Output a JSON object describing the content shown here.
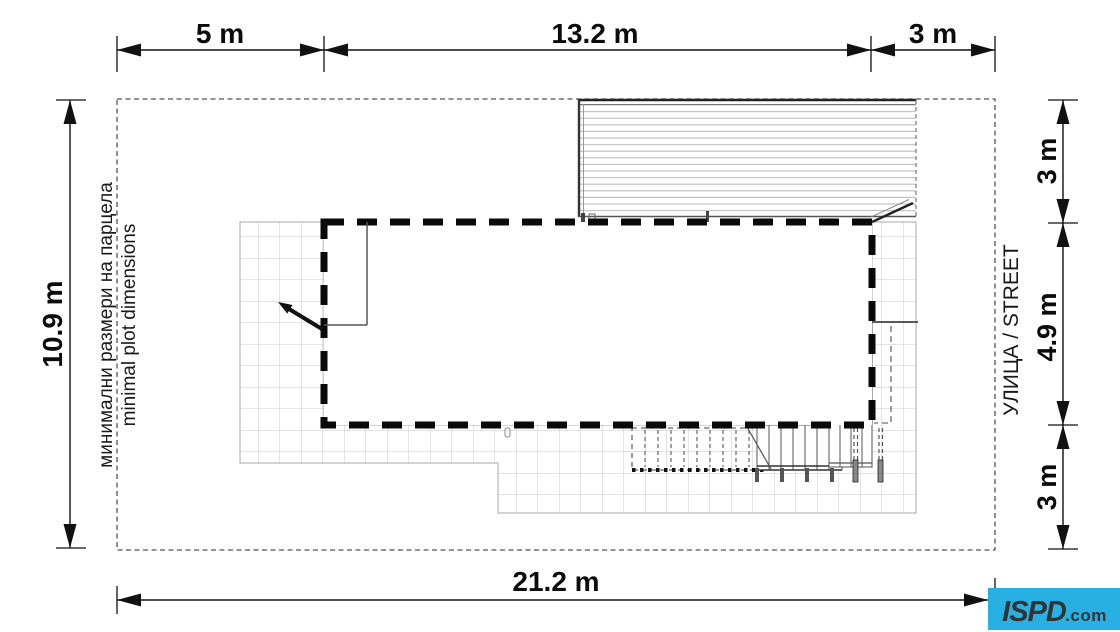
{
  "plot_note": {
    "bg": "минимални размери на парцела",
    "en": "minimal plot dimensions"
  },
  "street_label": "УЛИЦА / STREET",
  "dims": {
    "top_left": "5 m",
    "top_mid": "13.2 m",
    "top_right": "3 m",
    "left": "10.9 m",
    "right_top": "3 m",
    "right_mid": "4.9 m",
    "right_bottom": "3 m",
    "bottom": "21.2 m"
  },
  "logo": {
    "name": "ISPD",
    "tld": ".com",
    "bg_color": "#29b0e2",
    "text_color": "#333333"
  },
  "colors": {
    "building_outline": "#0a0a0a",
    "plot_boundary": "#555555",
    "grid_line": "#c9c9c9",
    "hatch_line": "#bdbdbd",
    "dim_line": "#111111"
  }
}
